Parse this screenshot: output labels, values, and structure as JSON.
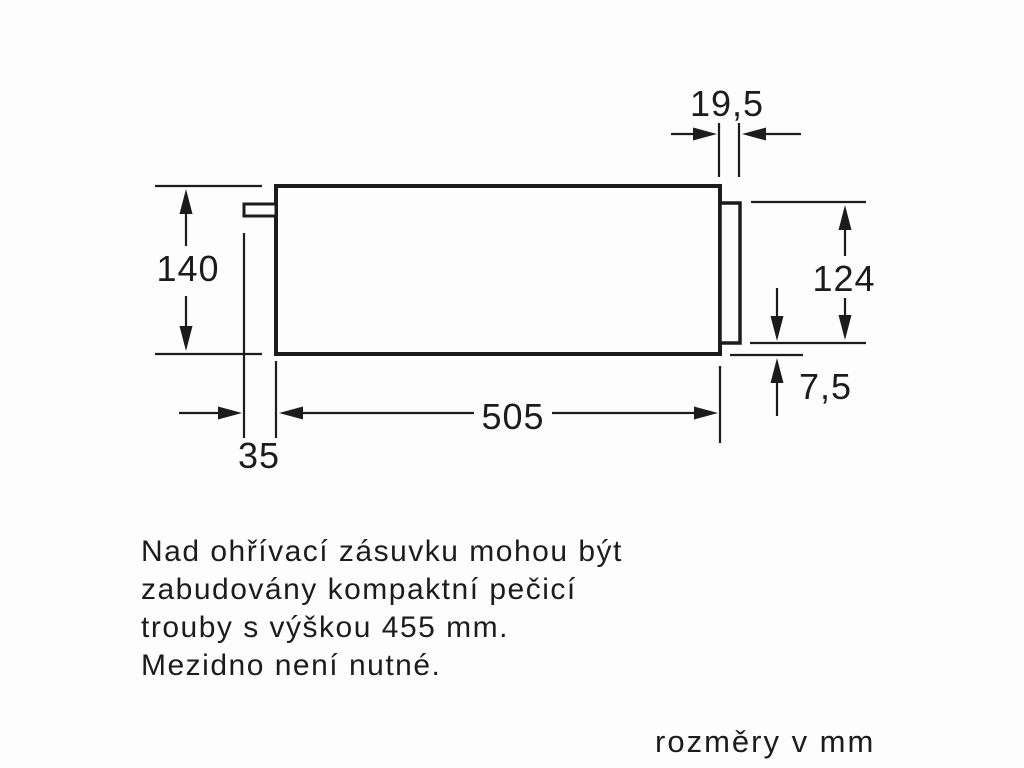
{
  "dimensions": {
    "front_panel_protrusion": "19,5",
    "niche_height": "140",
    "front_panel_height": "124",
    "bottom_overlap": "7,5",
    "body_depth": "505",
    "rear_offset": "35"
  },
  "note": {
    "lines": [
      "Nad ohřívací zásuvku mohou být",
      "zabudovány kompaktní pečicí",
      "trouby s výškou 455 mm.",
      "Mezidno není nutné."
    ]
  },
  "caption": "rozměry v mm",
  "colors": {
    "line": "#1c1c1c",
    "background": "#fdfdfd"
  }
}
